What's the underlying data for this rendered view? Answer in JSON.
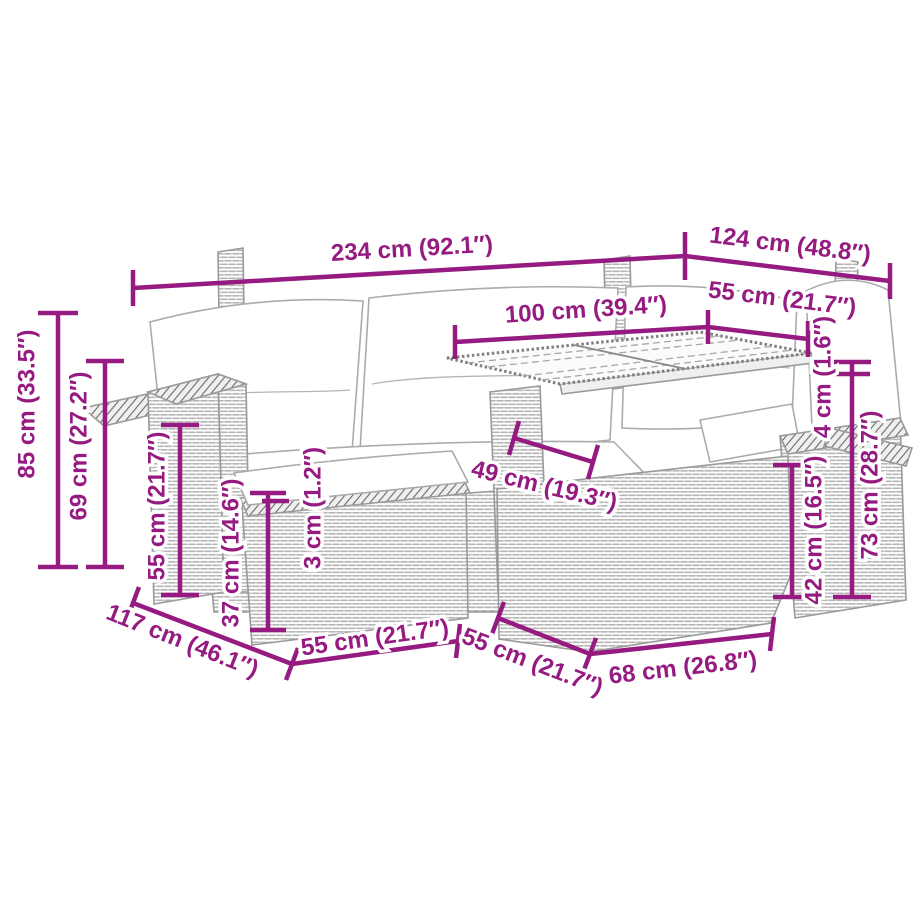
{
  "colors": {
    "accent": "#951b81",
    "furniture_line": "#9a9a9a",
    "background": "#ffffff"
  },
  "dims": {
    "top_width": "234 cm (92.1″)",
    "top_depth": "124 cm (48.8″)",
    "corner_seat_depth": "55 cm (21.7″)",
    "table_length": "100 cm (39.4″)",
    "overall_height": "85 cm (33.5″)",
    "backrest_height": "69 cm (27.2″)",
    "armrest_height": "55 cm (21.7″)",
    "seat_height": "37 cm (14.6″)",
    "cushion_thickness": "3 cm (1.2″)",
    "table_leg_span": "49 cm (19.3″)",
    "tabletop_thickness": "4 cm (1.6″)",
    "table_clearance": "42 cm (16.5″)",
    "table_height": "73 cm (28.7″)",
    "sofa_depth": "117 cm (46.1″)",
    "ottoman_width": "55 cm (21.7″)",
    "table_depth": "55 cm (21.7″)",
    "table_base_length": "68 cm (26.8″)"
  }
}
